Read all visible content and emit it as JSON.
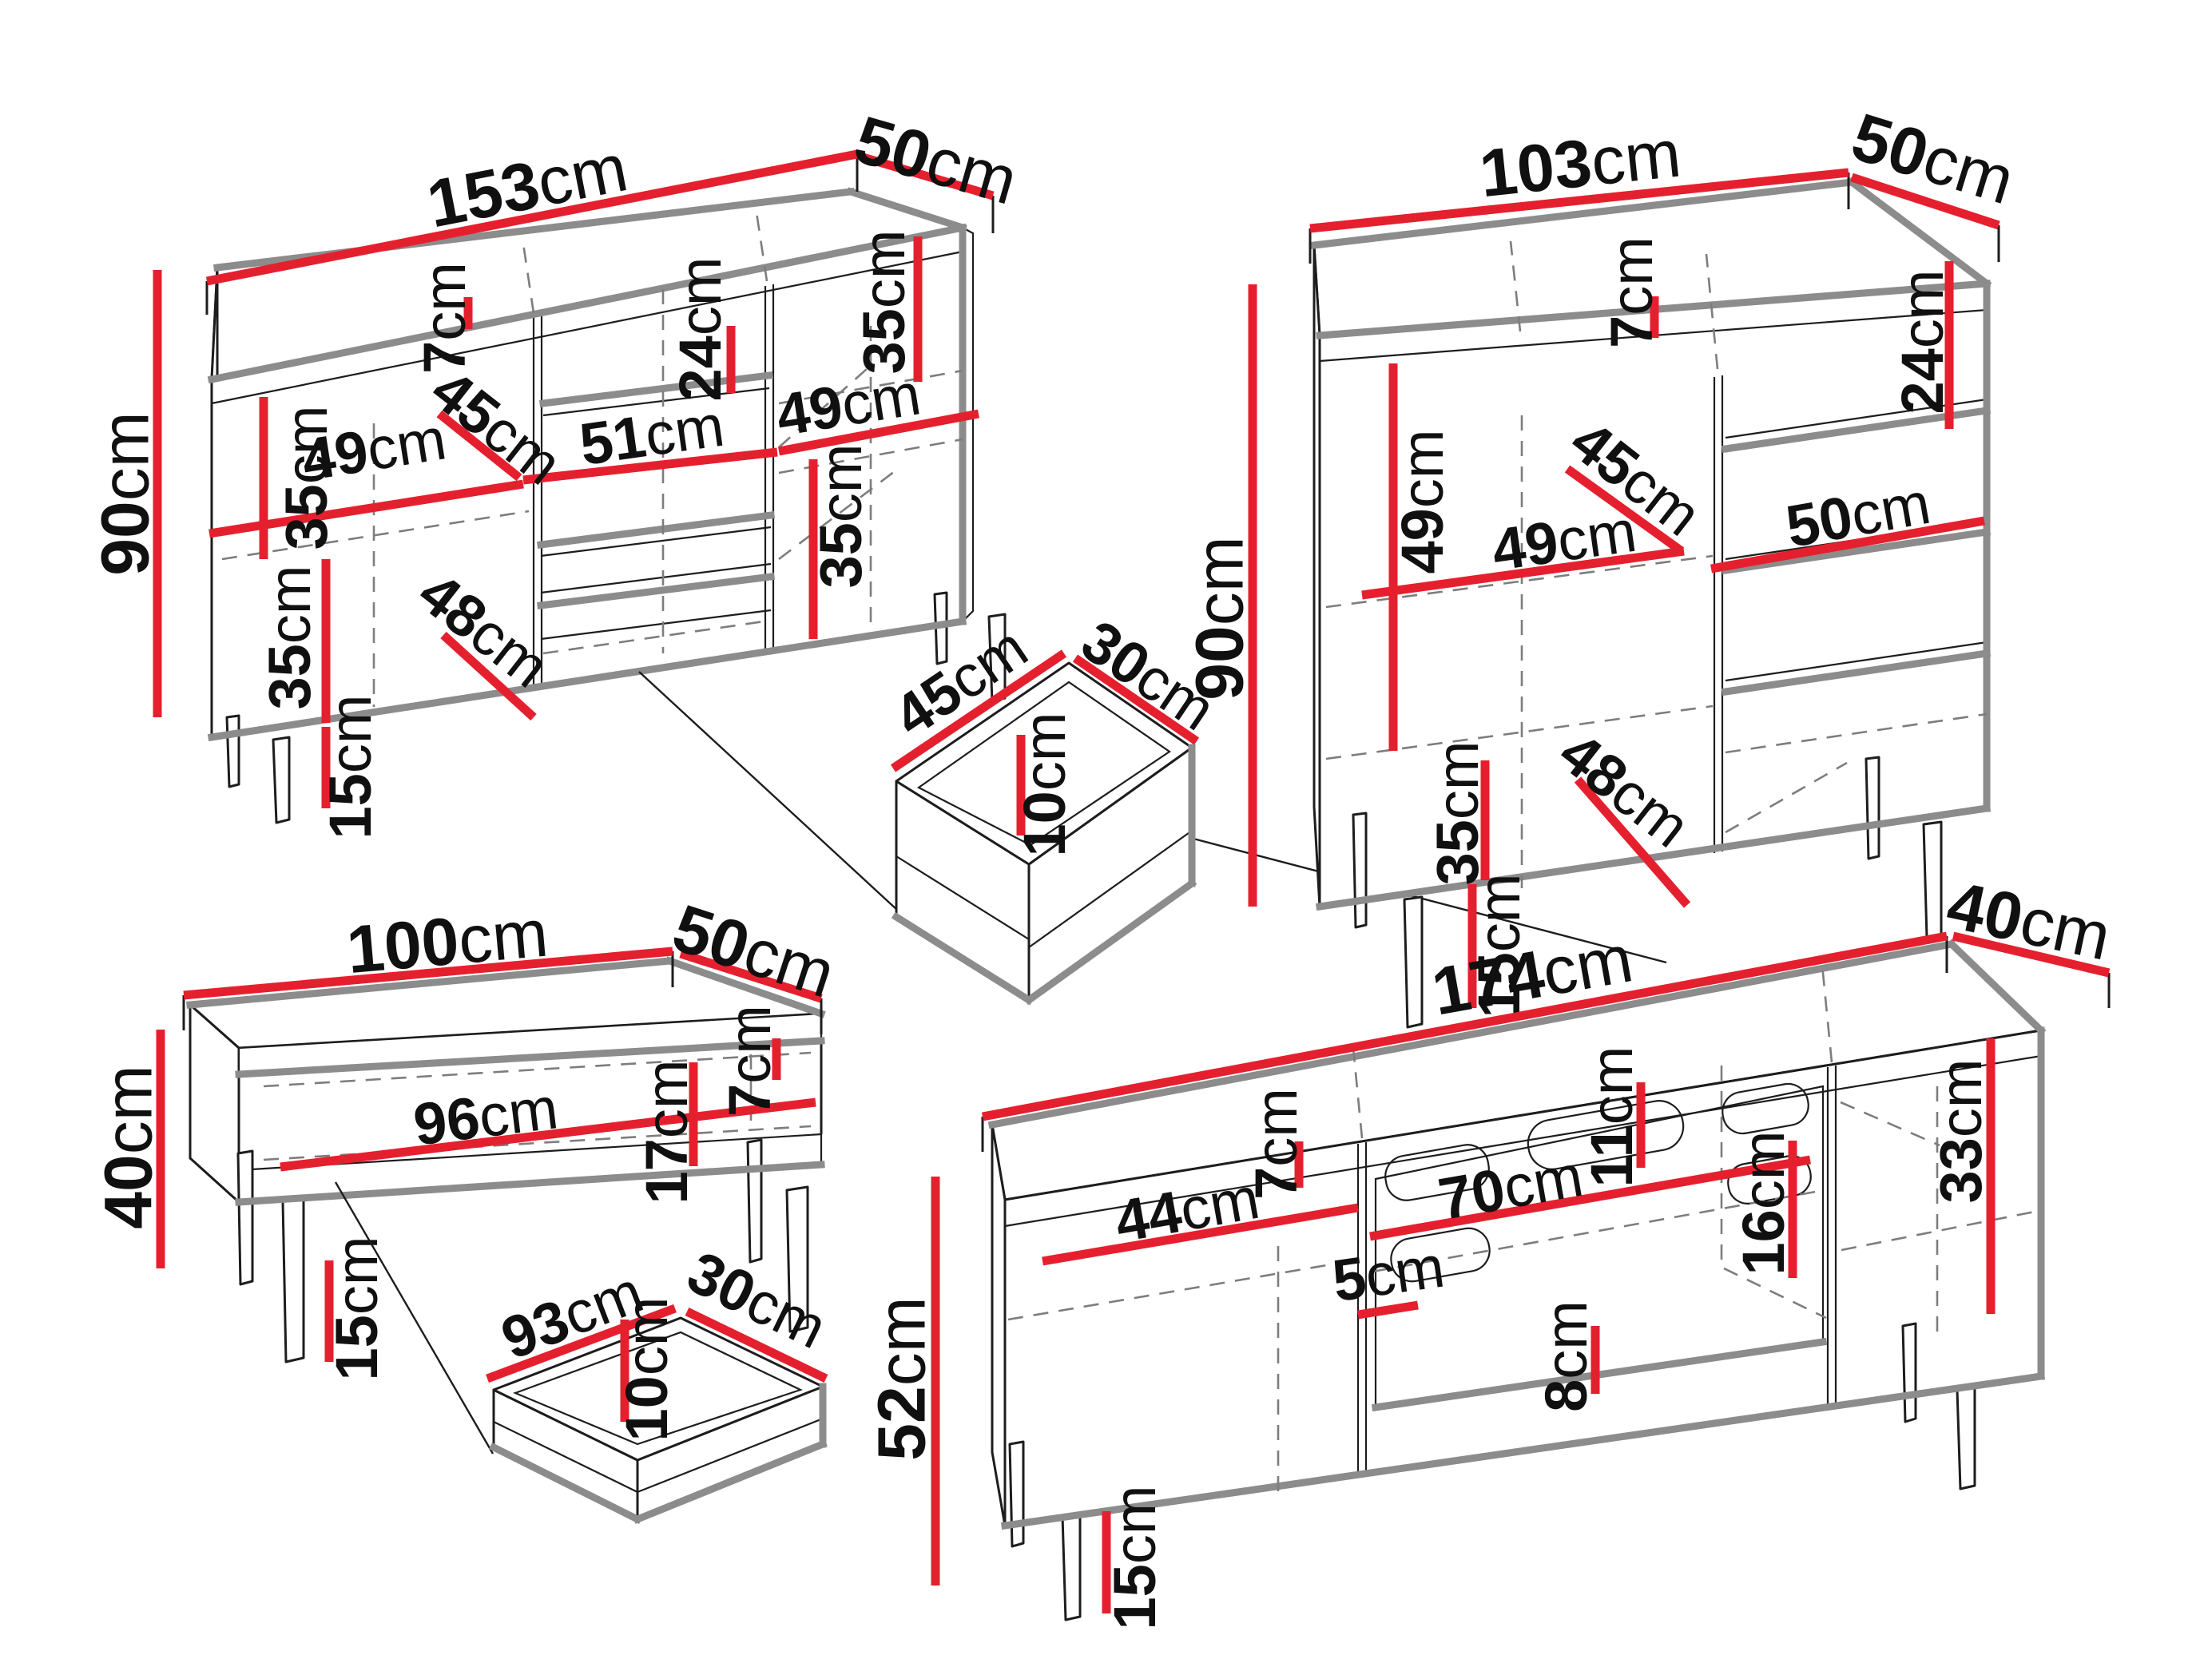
{
  "title": "Furniture set dimension diagram",
  "units": "cm",
  "colors": {
    "dimension_red": "#e5202e",
    "panel_gray": "#8c8c8c",
    "line_black": "#1d1d1d",
    "background": "#ffffff"
  },
  "pieces": {
    "sideboard_large": {
      "label": "large sideboard",
      "width": {
        "value": "153",
        "unit": "cm"
      },
      "depth": {
        "value": "50",
        "unit": "cm"
      },
      "height": {
        "value": "90",
        "unit": "cm"
      },
      "internal": {
        "shelf_top_left": {
          "value": "35",
          "unit": "cm"
        },
        "top_gap": {
          "value": "7",
          "unit": "cm"
        },
        "drawer_front": {
          "value": "24",
          "unit": "cm"
        },
        "shelf_top_right": {
          "value": "35",
          "unit": "cm"
        },
        "shelf_depth": {
          "value": "45",
          "unit": "cm"
        },
        "left_width": {
          "value": "49",
          "unit": "cm"
        },
        "middle_width": {
          "value": "51",
          "unit": "cm"
        },
        "right_width": {
          "value": "49",
          "unit": "cm"
        },
        "shelf_bottom_left": {
          "value": "35",
          "unit": "cm"
        },
        "bottom_shelf_depth": {
          "value": "48",
          "unit": "cm"
        },
        "shelf_bottom_right": {
          "value": "35",
          "unit": "cm"
        },
        "leg_height": {
          "value": "15",
          "unit": "cm"
        }
      }
    },
    "drawer_small": {
      "label": "internal drawer",
      "width": {
        "value": "45",
        "unit": "cm"
      },
      "depth": {
        "value": "30",
        "unit": "cm"
      },
      "height": {
        "value": "10",
        "unit": "cm"
      }
    },
    "sideboard_small": {
      "label": "small sideboard",
      "width": {
        "value": "103",
        "unit": "cm"
      },
      "depth": {
        "value": "50",
        "unit": "cm"
      },
      "height": {
        "value": "90",
        "unit": "cm"
      },
      "internal": {
        "door_shelf": {
          "value": "49",
          "unit": "cm"
        },
        "top_gap": {
          "value": "7",
          "unit": "cm"
        },
        "drawer_front": {
          "value": "24",
          "unit": "cm"
        },
        "shelf_depth": {
          "value": "45",
          "unit": "cm"
        },
        "door_width": {
          "value": "49",
          "unit": "cm"
        },
        "drawer_width": {
          "value": "50",
          "unit": "cm"
        },
        "shelf_bottom": {
          "value": "35",
          "unit": "cm"
        },
        "bottom_shelf_depth": {
          "value": "48",
          "unit": "cm"
        },
        "leg_height": {
          "value": "15",
          "unit": "cm"
        }
      }
    },
    "coffee_table": {
      "label": "coffee table",
      "width": {
        "value": "100",
        "unit": "cm"
      },
      "depth": {
        "value": "50",
        "unit": "cm"
      },
      "height": {
        "value": "40",
        "unit": "cm"
      },
      "internal": {
        "niche_width": {
          "value": "96",
          "unit": "cm"
        },
        "top_gap": {
          "value": "7",
          "unit": "cm"
        },
        "niche_height": {
          "value": "17",
          "unit": "cm"
        },
        "leg_height": {
          "value": "15",
          "unit": "cm"
        }
      }
    },
    "wide_drawer": {
      "label": "table drawer",
      "width": {
        "value": "93",
        "unit": "cm"
      },
      "depth": {
        "value": "30",
        "unit": "cm"
      },
      "height": {
        "value": "10",
        "unit": "cm"
      }
    },
    "tv_stand": {
      "label": "TV stand",
      "width": {
        "value": "174",
        "unit": "cm"
      },
      "depth": {
        "value": "40",
        "unit": "cm"
      },
      "height": {
        "value": "52",
        "unit": "cm"
      },
      "internal": {
        "left_width": {
          "value": "44",
          "unit": "cm"
        },
        "top_gap": {
          "value": "7",
          "unit": "cm"
        },
        "flap_width": {
          "value": "70",
          "unit": "cm"
        },
        "slot_offset": {
          "value": "11",
          "unit": "cm"
        },
        "slot_gap": {
          "value": "16",
          "unit": "cm"
        },
        "front_gap": {
          "value": "5",
          "unit": "cm"
        },
        "bottom_gap": {
          "value": "8",
          "unit": "cm"
        },
        "right_height": {
          "value": "33",
          "unit": "cm"
        },
        "leg_height": {
          "value": "15",
          "unit": "cm"
        }
      }
    }
  }
}
